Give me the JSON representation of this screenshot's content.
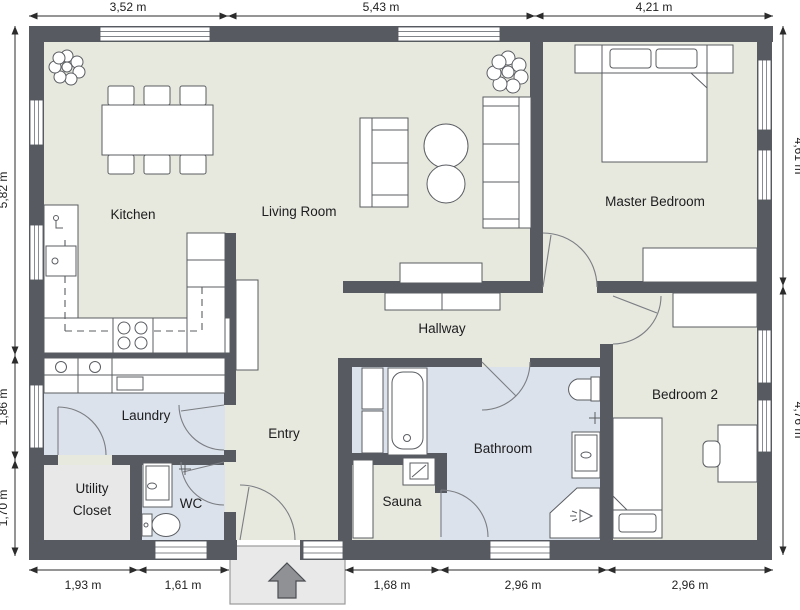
{
  "title": "Floor plan",
  "rooms": {
    "kitchen": "Kitchen",
    "living_room": "Living Room",
    "master_bedroom": "Master Bedroom",
    "hallway": "Hallway",
    "laundry": "Laundry",
    "entry": "Entry",
    "bathroom": "Bathroom",
    "sauna": "Sauna",
    "bedroom2": "Bedroom 2",
    "utility_line1": "Utility",
    "utility_line2": "Closet",
    "wc": "WC"
  },
  "dimensions": {
    "top": [
      "3,52 m",
      "5,43 m",
      "4,21 m"
    ],
    "bottom": [
      "1,93 m",
      "1,61 m",
      "1,68 m",
      "2,96 m",
      "2,96 m"
    ],
    "left": [
      "5,82 m",
      "1,86 m",
      "1,70 m"
    ],
    "right": [
      "4,61 m",
      "4,76 m"
    ]
  },
  "colors": {
    "wall": "#575b61",
    "floor": "#e7e8de",
    "wet_floor": "#dbe2eb",
    "utility_floor": "#e8e8e8",
    "porch": "#e9e9e9",
    "porch_border": "#9a9a9a",
    "entry_arrow": "#8f9194"
  }
}
